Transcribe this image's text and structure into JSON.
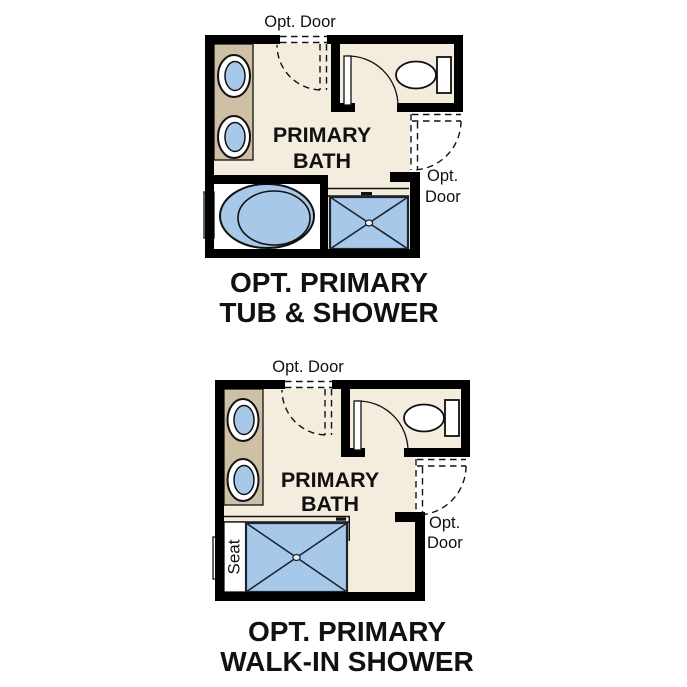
{
  "colors": {
    "background": "#ffffff",
    "wall": "#000000",
    "floor": "#f4ecdd",
    "counter_tan": "#cdc0a5",
    "fixture_blue": "#a7c8e9",
    "pan_border": "#1c2430",
    "text": "#111111"
  },
  "plans": [
    {
      "name": "tub-shower",
      "top_door_label": "Opt. Door",
      "room_label_line1": "PRIMARY",
      "room_label_line2": "BATH",
      "side_door_label_line1": "Opt.",
      "side_door_label_line2": "Door",
      "title_line1": "OPT. PRIMARY",
      "title_line2": "TUB & SHOWER"
    },
    {
      "name": "walk-in-shower",
      "top_door_label": "Opt. Door",
      "room_label_line1": "PRIMARY",
      "room_label_line2": "BATH",
      "side_door_label_line1": "Opt.",
      "side_door_label_line2": "Door",
      "seat_label": "Seat",
      "title_line1": "OPT. PRIMARY",
      "title_line2": "WALK-IN SHOWER"
    }
  ]
}
